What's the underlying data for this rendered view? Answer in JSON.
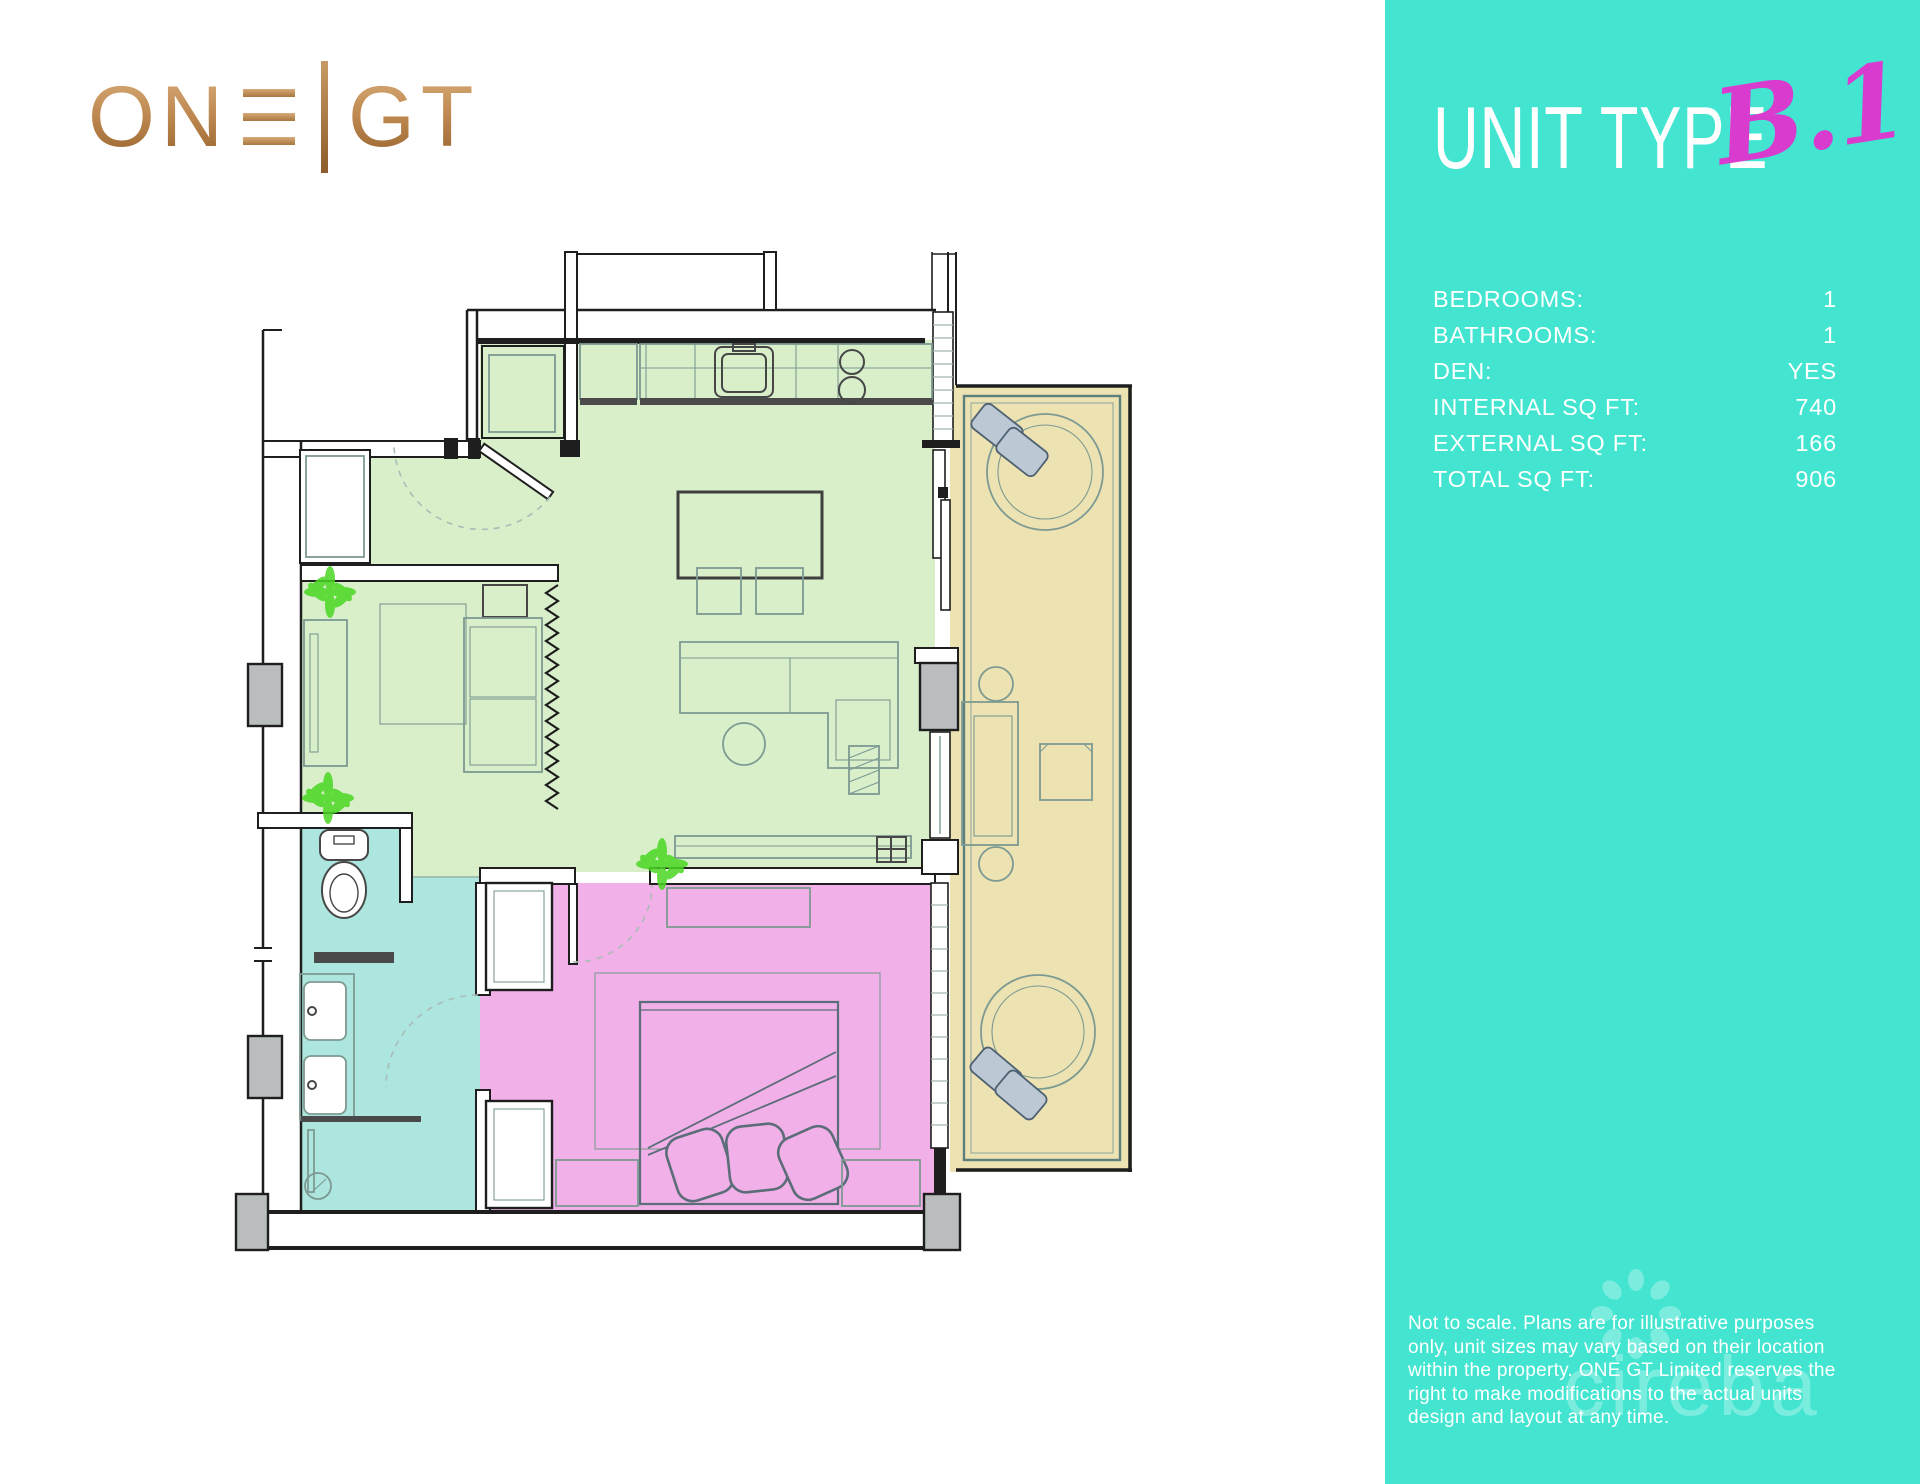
{
  "brand": {
    "name": "ONE GT",
    "left": "ON",
    "right": "GT"
  },
  "panel": {
    "title": "UNIT TYPE",
    "unit_code": "B.1",
    "specs": [
      {
        "label": "BEDROOMS:",
        "value": "1"
      },
      {
        "label": "BATHROOMS:",
        "value": "1"
      },
      {
        "label": "DEN:",
        "value": "YES"
      },
      {
        "label": "INTERNAL SQ FT:",
        "value": "740"
      },
      {
        "label": "EXTERNAL SQ FT:",
        "value": "166"
      },
      {
        "label": "TOTAL SQ FT:",
        "value": "906"
      }
    ],
    "disclaimer_lines": [
      "Not to scale. Plans are for illustrative purposes",
      "only, unit sizes may vary based on their location",
      "within the property. ONE GT Limited reserves the",
      "right to make modifications to the actual units",
      "design and layout at any time."
    ],
    "watermark": "cireba",
    "colors": {
      "background": "#43e5d1",
      "accent": "#d93bce",
      "text": "#ffffff"
    }
  },
  "floorplan": {
    "colors": {
      "living": "#d8efca",
      "bedroom": "#f2b0e8",
      "bathroom": "#ace6df",
      "balcony": "#ece2b2",
      "wall": "#1e1e1e",
      "furniture": "#7d9a92",
      "column": "#b9bdbd",
      "plant": "#4bd723"
    },
    "rooms": [
      {
        "name": "kitchen-living-dining",
        "color_key": "living"
      },
      {
        "name": "den",
        "color_key": "living"
      },
      {
        "name": "bathroom",
        "color_key": "bathroom"
      },
      {
        "name": "bedroom",
        "color_key": "bedroom"
      },
      {
        "name": "balcony",
        "color_key": "balcony"
      }
    ]
  }
}
